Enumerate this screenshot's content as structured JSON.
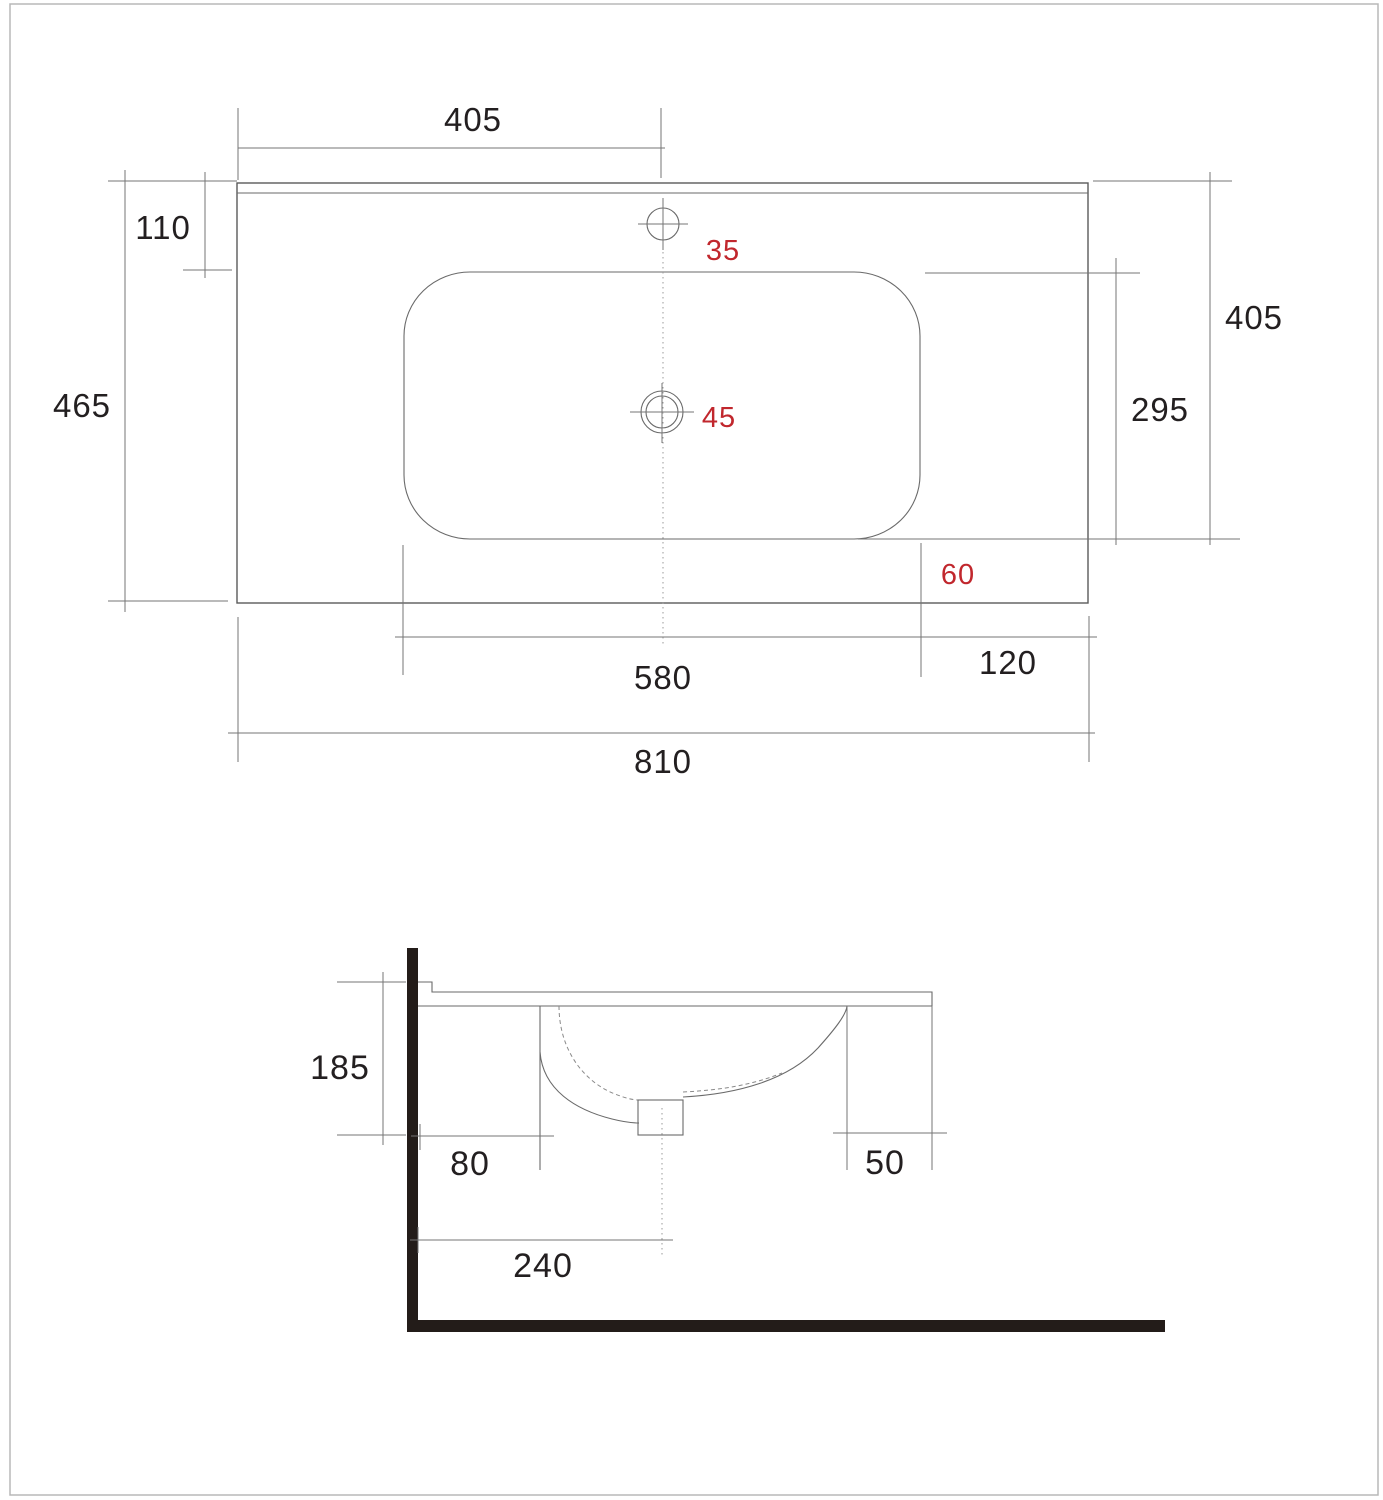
{
  "drawing": {
    "type": "washbasin-technical-drawing",
    "views": {
      "top_view_name": "plan view",
      "side_view_name": "section view"
    },
    "colors": {
      "line": "#5a5a5a",
      "dimension_line": "#757575",
      "accent_red": "#c1272d",
      "solid_fill": "#231c19",
      "background": "#ffffff"
    }
  },
  "top_view": {
    "dimensions": {
      "faucet_offset": "405",
      "rim_to_basin": "110",
      "overall_depth": "465",
      "faucet_hole_diameter": "35",
      "drain_hole_diameter": "45",
      "top_to_basin_bottom": "405",
      "basin_depth": "295",
      "basin_to_front_edge": "60",
      "basin_width": "580",
      "basin_to_right_edge": "120",
      "overall_width": "810"
    }
  },
  "side_view": {
    "dimensions": {
      "overall_height": "185",
      "wall_to_basin": "80",
      "basin_to_counter_edge": "50",
      "wall_to_drain_center": "240"
    }
  }
}
